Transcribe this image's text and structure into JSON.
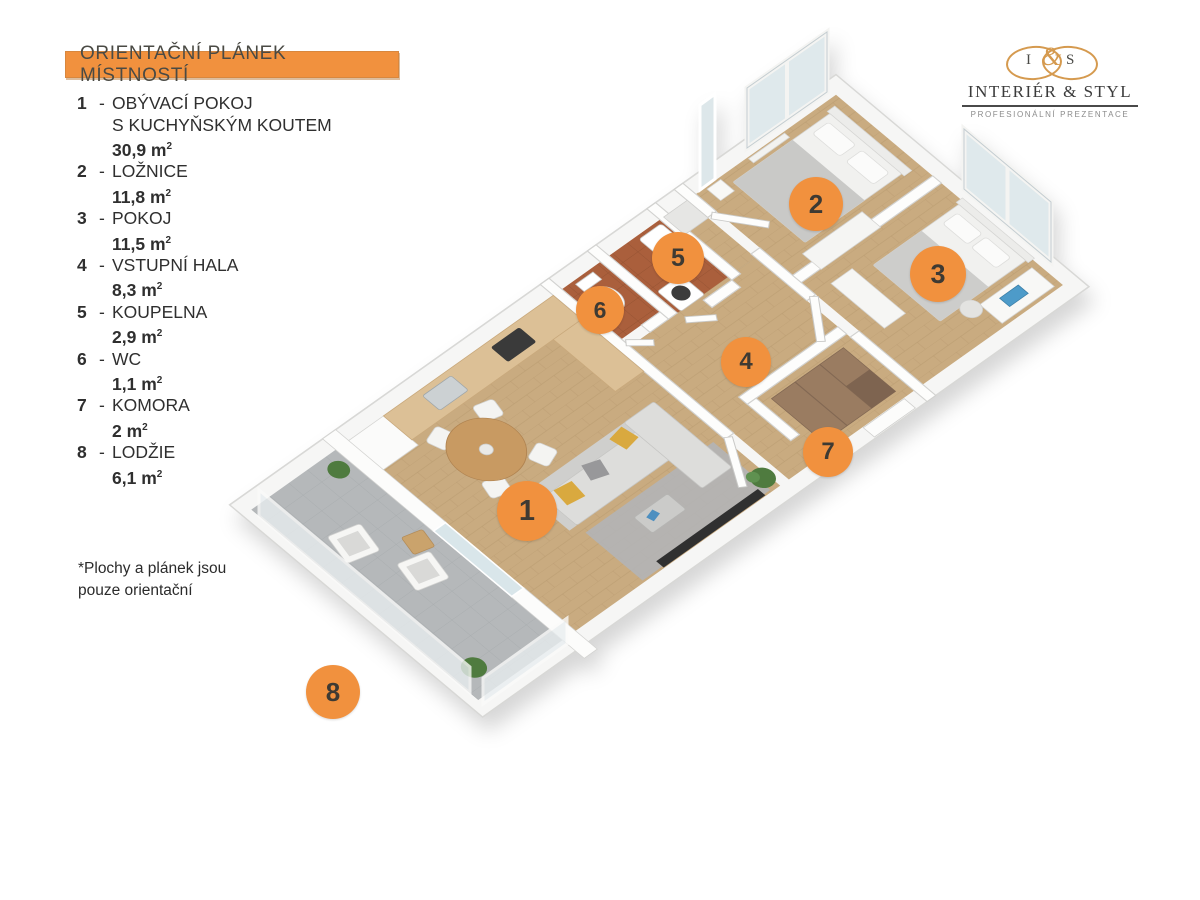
{
  "header": {
    "title": "ORIENTAČNÍ PLÁNEK MÍSTNOSTÍ"
  },
  "logo": {
    "monogram": {
      "left": "I",
      "amp": "&",
      "right": "S"
    },
    "name": "INTERIÉR & STYL",
    "tagline": "PROFESIONÁLNÍ PREZENTACE"
  },
  "legend": {
    "dash": "-",
    "unit": "m",
    "unit_sup": "2",
    "items": [
      {
        "num": "1",
        "name_lines": [
          "OBÝVACÍ POKOJ",
          "S KUCHYŇSKÝM KOUTEM"
        ],
        "area": "30,9"
      },
      {
        "num": "2",
        "name_lines": [
          "LOŽNICE"
        ],
        "area": "11,8"
      },
      {
        "num": "3",
        "name_lines": [
          "POKOJ"
        ],
        "area": "11,5"
      },
      {
        "num": "4",
        "name_lines": [
          "VSTUPNÍ HALA"
        ],
        "area": "8,3"
      },
      {
        "num": "5",
        "name_lines": [
          "KOUPELNA"
        ],
        "area": "2,9"
      },
      {
        "num": "6",
        "name_lines": [
          "WC"
        ],
        "area": "1,1"
      },
      {
        "num": "7",
        "name_lines": [
          "KOMORA"
        ],
        "area": "2"
      },
      {
        "num": "8",
        "name_lines": [
          "LODŽIE"
        ],
        "area": "6,1"
      }
    ]
  },
  "footnote": {
    "lines": [
      "*Plochy  a plánek jsou",
      "pouze orientační"
    ]
  },
  "plan_markers": [
    {
      "num": "1",
      "x": 527,
      "y": 511,
      "r": 30
    },
    {
      "num": "2",
      "x": 816,
      "y": 204,
      "r": 27
    },
    {
      "num": "3",
      "x": 938,
      "y": 274,
      "r": 28
    },
    {
      "num": "4",
      "x": 746,
      "y": 362,
      "r": 25
    },
    {
      "num": "5",
      "x": 678,
      "y": 258,
      "r": 26
    },
    {
      "num": "6",
      "x": 600,
      "y": 310,
      "r": 24
    },
    {
      "num": "7",
      "x": 828,
      "y": 452,
      "r": 25
    },
    {
      "num": "8",
      "x": 333,
      "y": 692,
      "r": 27
    }
  ],
  "colors": {
    "accent_orange": "#F1913E",
    "marker_digit": "#3e3a33",
    "legend_text": "#2f2f2f",
    "logo_gold": "#D59A4F",
    "wood_floor": "#c9ab80",
    "tile_floor": "#aa5f3c",
    "loggia_floor": "#b5b8ba"
  }
}
